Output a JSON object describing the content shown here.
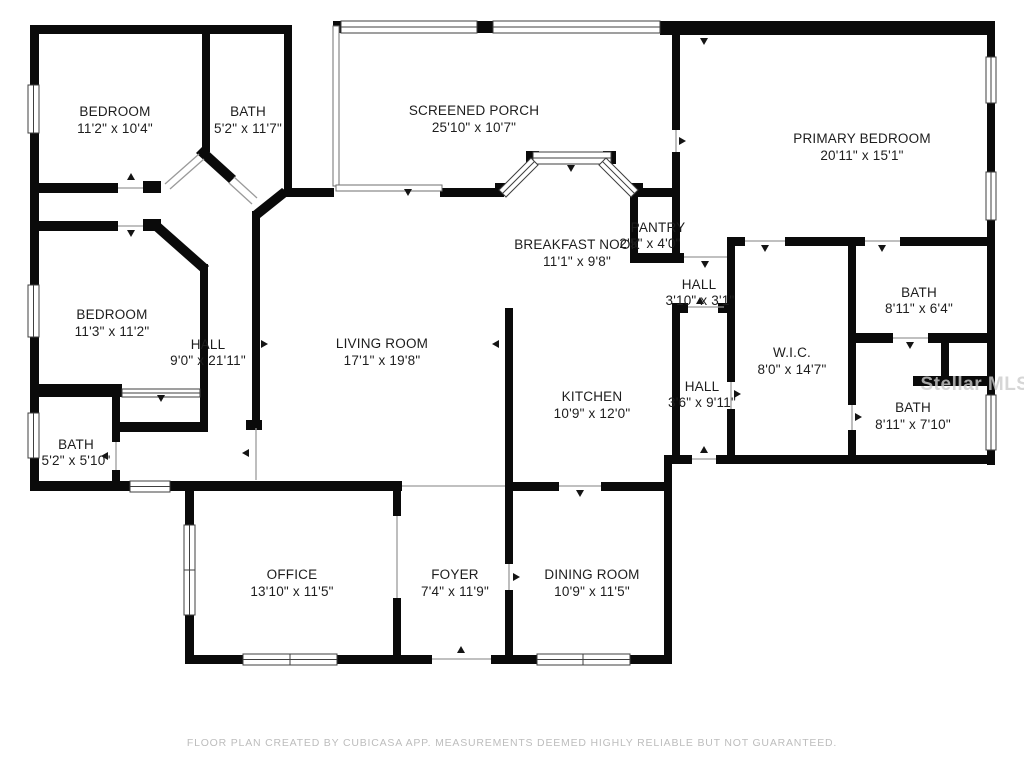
{
  "plan": {
    "type": "residential-floor-plan",
    "wall_color": "#0a0a0a",
    "label_color": "#1d1d1d",
    "footer_color": "#bdbdbd",
    "watermark_color": "#cccccc"
  },
  "rooms": [
    {
      "id": "bedroom-1",
      "name": "BEDROOM",
      "dims": "11'2\" x 10'4\""
    },
    {
      "id": "bath-1",
      "name": "BATH",
      "dims": "5'2\" x 11'7\""
    },
    {
      "id": "screened-porch",
      "name": "SCREENED PORCH",
      "dims": "25'10\" x 10'7\""
    },
    {
      "id": "primary-bedroom",
      "name": "PRIMARY BEDROOM",
      "dims": "20'11\" x 15'1\""
    },
    {
      "id": "breakfast-nook",
      "name": "BREAKFAST NOOK",
      "dims": "11'1\" x 9'8\""
    },
    {
      "id": "pantry",
      "name": "PANTRY",
      "dims": "2'5\" x 4'0\""
    },
    {
      "id": "hall-upper",
      "name": "HALL",
      "dims": "3'10\" x 3'1\""
    },
    {
      "id": "bedroom-2",
      "name": "BEDROOM",
      "dims": "11'3\" x 11'2\""
    },
    {
      "id": "hall-main",
      "name": "HALL",
      "dims": "9'0\" x 21'11\""
    },
    {
      "id": "living-room",
      "name": "LIVING ROOM",
      "dims": "17'1\" x 19'8\""
    },
    {
      "id": "kitchen",
      "name": "KITCHEN",
      "dims": "10'9\" x 12'0\""
    },
    {
      "id": "wic",
      "name": "W.I.C.",
      "dims": "8'0\" x 14'7\""
    },
    {
      "id": "bath-2",
      "name": "BATH",
      "dims": "8'11\" x 6'4\""
    },
    {
      "id": "hall-lower",
      "name": "HALL",
      "dims": "3'6\" x 9'11\""
    },
    {
      "id": "bath-3",
      "name": "BATH",
      "dims": "8'11\" x 7'10\""
    },
    {
      "id": "bath-4",
      "name": "BATH",
      "dims": "5'2\" x 5'10\""
    },
    {
      "id": "office",
      "name": "OFFICE",
      "dims": "13'10\" x 11'5\""
    },
    {
      "id": "foyer",
      "name": "FOYER",
      "dims": "7'4\" x 11'9\""
    },
    {
      "id": "dining-room",
      "name": "DINING ROOM",
      "dims": "10'9\" x 11'5\""
    }
  ],
  "watermark": {
    "text": "Stellar MLS"
  },
  "footer": {
    "text": "FLOOR PLAN CREATED BY CUBICASA APP. MEASUREMENTS DEEMED HIGHLY RELIABLE BUT NOT GUARANTEED."
  }
}
